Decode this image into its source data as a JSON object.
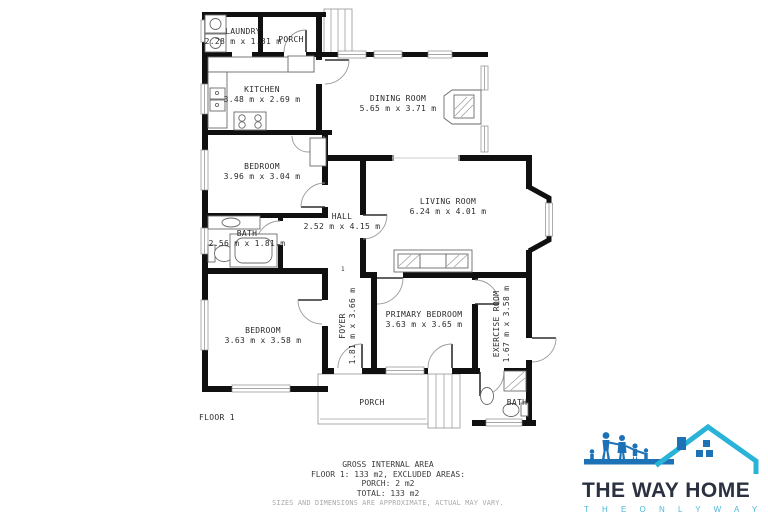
{
  "floorplan": {
    "floor_label": "FLOOR 1",
    "step_marker": "1",
    "rooms": [
      {
        "name": "LAUNDRY",
        "dims": "2.28 m x 1.31 m"
      },
      {
        "name": "PORCH",
        "dims": ""
      },
      {
        "name": "KITCHEN",
        "dims": "3.48 m x 2.69 m"
      },
      {
        "name": "DINING ROOM",
        "dims": "5.65 m x 3.71 m"
      },
      {
        "name": "BEDROOM",
        "dims": "3.96 m x 3.04 m"
      },
      {
        "name": "LIVING ROOM",
        "dims": "6.24 m x 4.01 m"
      },
      {
        "name": "HALL",
        "dims": "2.52 m x 4.15 m"
      },
      {
        "name": "BATH",
        "dims": "2.56 m x 1.81 m"
      },
      {
        "name": "BEDROOM",
        "dims": "3.63 m x 3.58 m"
      },
      {
        "name": "FOYER",
        "dims": "1.81 m x 3.66 m"
      },
      {
        "name": "PRIMARY BEDROOM",
        "dims": "3.63 m x 3.65 m"
      },
      {
        "name": "EXERCISE ROOM",
        "dims": "1.67 m x 3.58 m"
      },
      {
        "name": "PORCH",
        "dims": ""
      },
      {
        "name": "BATH",
        "dims": ""
      }
    ]
  },
  "footer": {
    "line1": "GROSS INTERNAL AREA",
    "line2": "FLOOR 1: 133 m2, EXCLUDED AREAS:",
    "line3": "PORCH: 2 m2",
    "line4": "TOTAL: 133 m2",
    "disclaimer": "SIZES AND DIMENSIONS ARE APPROXIMATE, ACTUAL MAY VARY."
  },
  "logo": {
    "title": "THE WAY HOME",
    "tagline": "T H E   O N L Y   W A Y",
    "colors": {
      "navy": "#2b3140",
      "blue": "#1d72b7",
      "teal": "#29b3d8"
    }
  }
}
